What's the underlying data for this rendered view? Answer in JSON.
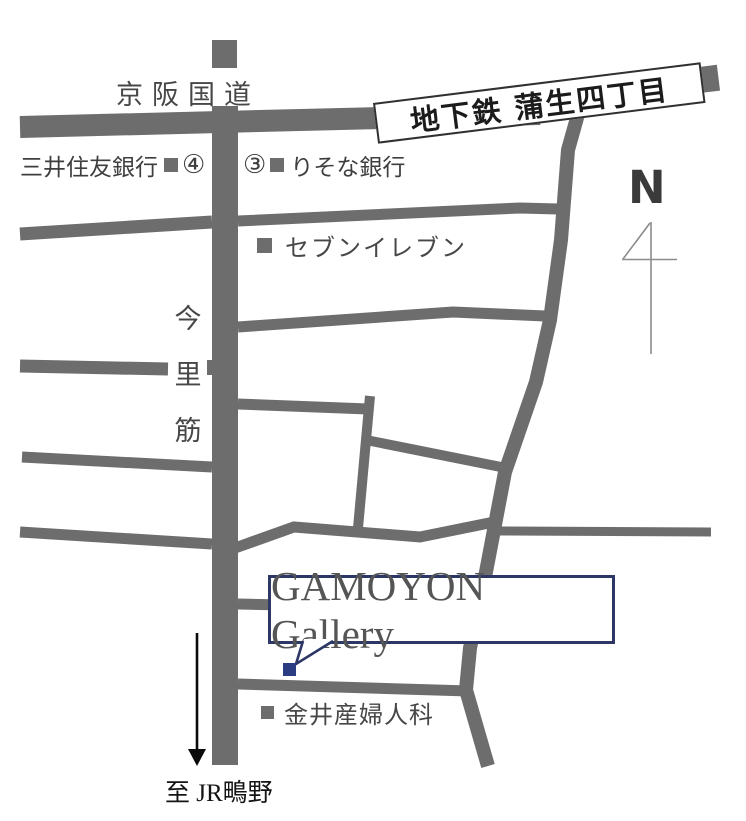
{
  "map_title": "GAMOYON Gallery access map",
  "labels": {
    "keihan_road": "京阪国道",
    "subway_banner": "地下鉄 蒲生四丁目",
    "bank_smbc": "三井住友銀行",
    "exit_4": "④",
    "exit_3": "③",
    "bank_resona": "りそな銀行",
    "seven_eleven": "セブンイレブン",
    "imazato_1": "今",
    "imazato_2": "里",
    "imazato_3": "筋",
    "compass_north": "N",
    "gallery": "GAMOYON Gallery",
    "clinic": "金井産婦人科",
    "to_jr": "至 JR鴫野"
  },
  "colors": {
    "road_gray": "#6d6d6d",
    "label_text": "#474747",
    "banner_border": "#303030",
    "banner_text": "#1b1b1b",
    "gallery_box_navy": "#2c3766",
    "gallery_marker_navy": "#2c3c82",
    "arrow_black": "#0b0b0b",
    "compass_line": "#8c8c8c"
  }
}
